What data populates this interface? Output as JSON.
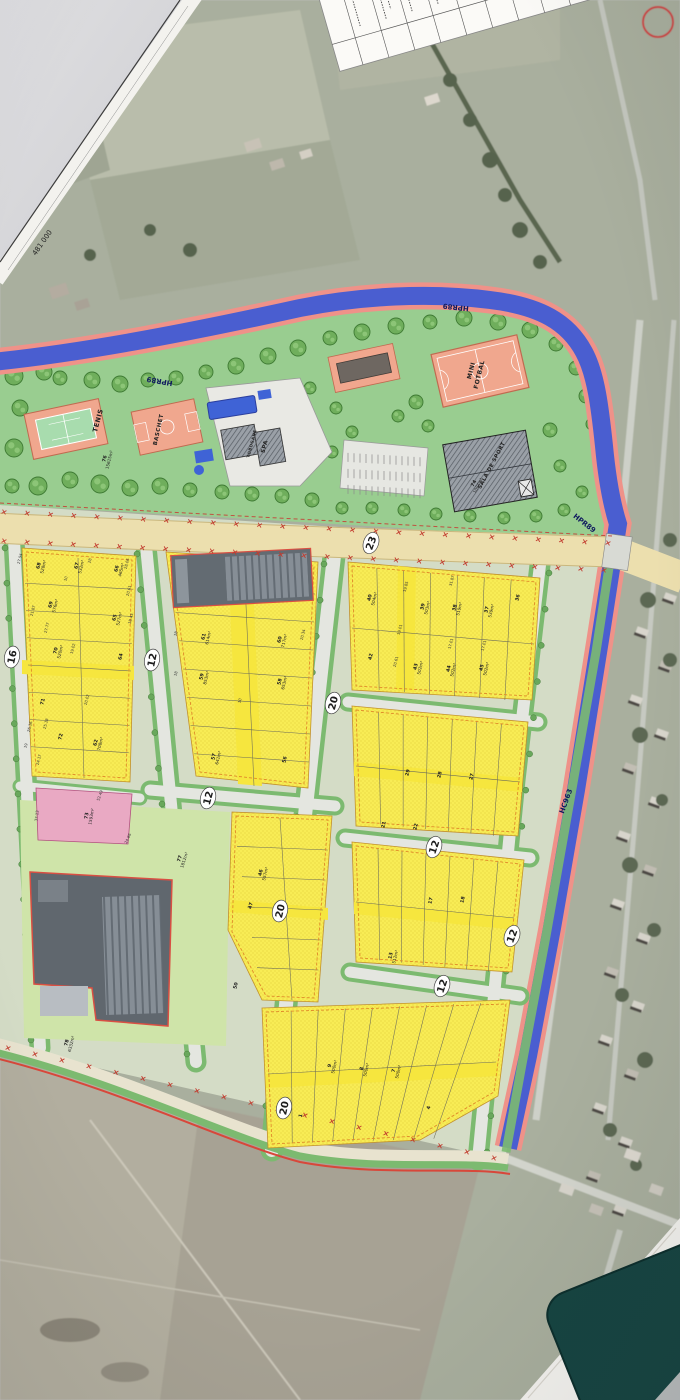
{
  "palette": {
    "desk": "#d8d8da",
    "satellite": "#a9af9e",
    "park_green": "#99cd90",
    "parcel_yellow": "#f8ec55",
    "alley_yellow": "#f6e63e",
    "parcel_pink": "#e9a9c3",
    "parcel_light_green": "#cfe4a9",
    "river_blue": "#4a5ed0",
    "river_edge_pink": "#ef9289",
    "boundary_red": "#d8473a",
    "road_tan": "#ecdfae",
    "street_gray": "#e4e6e0",
    "verge_green": "#7cba70",
    "court_salmon": "#f0a78e",
    "court_green": "#a8dcae",
    "building_gray": "#9aa0a7",
    "roof_dark": "#5a6168",
    "badge_bg": "#ffffff",
    "ink": "#1c1c1c",
    "hydro_ink": "#101a5e",
    "teal_object": "#174542"
  },
  "sheet": {
    "coordinate_label": "481 000"
  },
  "hydro_labels": [
    {
      "t": "HPR89",
      "x": 160,
      "y": 379,
      "r": 190
    },
    {
      "t": "HPR89",
      "x": 456,
      "y": 305,
      "r": 186
    },
    {
      "t": "HPR89",
      "x": 583,
      "y": 525,
      "r": 38
    },
    {
      "t": "HC963",
      "x": 568,
      "y": 802,
      "r": -70
    }
  ],
  "road_badges": [
    {
      "t": "23",
      "x": 371,
      "y": 543,
      "r": -70
    },
    {
      "t": "16",
      "x": 12,
      "y": 657,
      "r": -78
    },
    {
      "t": "12",
      "x": 152,
      "y": 660,
      "r": -78
    },
    {
      "t": "20",
      "x": 333,
      "y": 703,
      "r": -75
    },
    {
      "t": "12",
      "x": 208,
      "y": 798,
      "r": -75
    },
    {
      "t": "12",
      "x": 434,
      "y": 847,
      "r": -72
    },
    {
      "t": "20",
      "x": 280,
      "y": 911,
      "r": -76
    },
    {
      "t": "12",
      "x": 512,
      "y": 936,
      "r": -70
    },
    {
      "t": "12",
      "x": 442,
      "y": 986,
      "r": -72
    },
    {
      "t": "20",
      "x": 284,
      "y": 1108,
      "r": -78
    }
  ],
  "facility_labels": [
    {
      "t": "TENIS",
      "x": 100,
      "y": 421,
      "r": -75,
      "s": 6.5
    },
    {
      "t": "BASCHET",
      "x": 160,
      "y": 430,
      "r": -78,
      "s": 5.5
    },
    {
      "t": "TOBOGANE",
      "x": 253,
      "y": 444,
      "r": -75,
      "s": 4
    },
    {
      "t": "SPA",
      "x": 266,
      "y": 447,
      "r": -75,
      "s": 5.5
    },
    {
      "t": "MINI",
      "x": 473,
      "y": 371,
      "r": -76,
      "s": 6
    },
    {
      "t": "FOTBAL",
      "x": 481,
      "y": 375,
      "r": -76,
      "s": 6
    },
    {
      "t": "SALA DE SPORT",
      "x": 493,
      "y": 466,
      "r": -62,
      "s": 5.2
    }
  ],
  "parcel_labels": [
    {
      "n": "68",
      "a": "528m²",
      "x": 40,
      "y": 566
    },
    {
      "n": "67",
      "a": "532m²",
      "x": 78,
      "y": 566
    },
    {
      "n": "66",
      "a": "465m²",
      "x": 118,
      "y": 569
    },
    {
      "n": "69",
      "a": "576m²",
      "x": 52,
      "y": 605
    },
    {
      "n": "65",
      "a": "527m²",
      "x": 116,
      "y": 618
    },
    {
      "n": "70",
      "a": "520m²",
      "x": 57,
      "y": 651
    },
    {
      "n": "64",
      "a": "",
      "x": 122,
      "y": 657
    },
    {
      "n": "71",
      "a": "",
      "x": 44,
      "y": 702
    },
    {
      "n": "72",
      "a": "",
      "x": 62,
      "y": 737
    },
    {
      "n": "62",
      "a": "708m²",
      "x": 97,
      "y": 743
    },
    {
      "n": "61",
      "a": "614m²",
      "x": 205,
      "y": 637
    },
    {
      "n": "60",
      "a": "717m²",
      "x": 281,
      "y": 640
    },
    {
      "n": "59",
      "a": "853m²",
      "x": 203,
      "y": 677
    },
    {
      "n": "58",
      "a": "653m²",
      "x": 281,
      "y": 682
    },
    {
      "n": "57",
      "a": "641m²",
      "x": 215,
      "y": 757
    },
    {
      "n": "56",
      "a": "",
      "x": 286,
      "y": 760
    },
    {
      "n": "40",
      "a": "504m²",
      "x": 371,
      "y": 598
    },
    {
      "n": "39",
      "a": "503m²",
      "x": 424,
      "y": 607
    },
    {
      "n": "38",
      "a": "519m²",
      "x": 456,
      "y": 608
    },
    {
      "n": "37",
      "a": "539m²",
      "x": 488,
      "y": 610
    },
    {
      "n": "36",
      "a": "",
      "x": 519,
      "y": 598
    },
    {
      "n": "42",
      "a": "",
      "x": 372,
      "y": 657
    },
    {
      "n": "43",
      "a": "502m²",
      "x": 417,
      "y": 667
    },
    {
      "n": "44",
      "a": "502m²",
      "x": 450,
      "y": 669
    },
    {
      "n": "45",
      "a": "502m²",
      "x": 483,
      "y": 668
    },
    {
      "n": "29",
      "a": "",
      "x": 409,
      "y": 773
    },
    {
      "n": "28",
      "a": "",
      "x": 441,
      "y": 775
    },
    {
      "n": "27",
      "a": "",
      "x": 473,
      "y": 777
    },
    {
      "n": "21",
      "a": "",
      "x": 385,
      "y": 825
    },
    {
      "n": "22",
      "a": "",
      "x": 417,
      "y": 827
    },
    {
      "n": "46",
      "a": "557m²",
      "x": 262,
      "y": 873
    },
    {
      "n": "47",
      "a": "",
      "x": 252,
      "y": 906
    },
    {
      "n": "50",
      "a": "",
      "x": 237,
      "y": 986
    },
    {
      "n": "17",
      "a": "",
      "x": 432,
      "y": 901
    },
    {
      "n": "18",
      "a": "",
      "x": 464,
      "y": 900
    },
    {
      "n": "13",
      "a": "512m²",
      "x": 392,
      "y": 956
    },
    {
      "n": "9",
      "a": "500m²",
      "x": 331,
      "y": 1066
    },
    {
      "n": "8",
      "a": "500m²",
      "x": 363,
      "y": 1069
    },
    {
      "n": "7",
      "a": "500m²",
      "x": 395,
      "y": 1071
    },
    {
      "n": "1",
      "a": "",
      "x": 302,
      "y": 1116
    },
    {
      "n": "4",
      "a": "",
      "x": 430,
      "y": 1108
    },
    {
      "n": "73",
      "a": "1593m²",
      "x": 88,
      "y": 816,
      "r": -80
    },
    {
      "n": "74",
      "a": "1084m²",
      "x": 475,
      "y": 484,
      "r": -62
    },
    {
      "n": "76",
      "a": "15615m²",
      "x": 106,
      "y": 459
    },
    {
      "n": "77",
      "a": "1812m²",
      "x": 181,
      "y": 859,
      "r": -72
    },
    {
      "n": "78",
      "a": "6332m²",
      "x": 68,
      "y": 1043
    }
  ],
  "dim_labels": [
    {
      "t": "27.94",
      "x": 21,
      "y": 559
    },
    {
      "t": "28",
      "x": 91,
      "y": 561
    },
    {
      "t": "28.06",
      "x": 128,
      "y": 564
    },
    {
      "t": "20.61",
      "x": 130,
      "y": 591
    },
    {
      "t": "21.87",
      "x": 34,
      "y": 611
    },
    {
      "t": "27.77",
      "x": 48,
      "y": 628
    },
    {
      "t": "19.02",
      "x": 74,
      "y": 649
    },
    {
      "t": "18.43",
      "x": 132,
      "y": 619
    },
    {
      "t": "19",
      "x": 27,
      "y": 746
    },
    {
      "t": "10",
      "x": 67,
      "y": 579
    },
    {
      "t": "18",
      "x": 177,
      "y": 634
    },
    {
      "t": "20.34",
      "x": 304,
      "y": 635
    },
    {
      "t": "18",
      "x": 177,
      "y": 674
    },
    {
      "t": "10",
      "x": 241,
      "y": 701
    },
    {
      "t": "19.01",
      "x": 401,
      "y": 630
    },
    {
      "t": "17.01",
      "x": 452,
      "y": 644
    },
    {
      "t": "20.61",
      "x": 397,
      "y": 662
    },
    {
      "t": "31.87",
      "x": 453,
      "y": 581
    },
    {
      "t": "19.85",
      "x": 407,
      "y": 587
    },
    {
      "t": "17.01",
      "x": 485,
      "y": 646
    },
    {
      "t": "37.13",
      "x": 38,
      "y": 816,
      "r": -82
    },
    {
      "t": "52.49",
      "x": 101,
      "y": 796,
      "r": -70
    },
    {
      "t": "24.86",
      "x": 129,
      "y": 839,
      "r": -65
    },
    {
      "t": "26.16",
      "x": 31,
      "y": 727
    },
    {
      "t": "25.18",
      "x": 47,
      "y": 724
    },
    {
      "t": "24.17",
      "x": 40,
      "y": 760
    },
    {
      "t": "20.02",
      "x": 88,
      "y": 700
    }
  ]
}
